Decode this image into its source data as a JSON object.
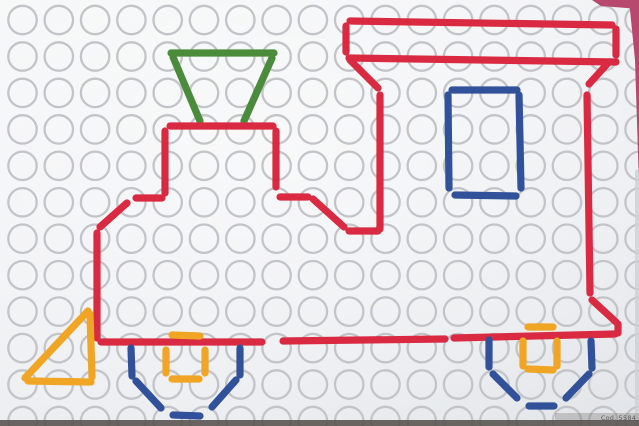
{
  "photo": {
    "subject": "pegboard toy showing a locomotive built from colored stick pieces",
    "caption": "Cod. 5584",
    "board": {
      "cols": 18,
      "rows": 12,
      "origin_x": 22.5,
      "origin_y": 20,
      "spacing_x": 36.3,
      "spacing_y": 36.45,
      "hole_radius": 14.2,
      "hole_stroke_width": 2.3
    },
    "piece_width": 7.2,
    "colors": {
      "red": "#d92a42",
      "green": "#4a8b3c",
      "blue": "#31519a",
      "orange": "#f0a524",
      "hole_stroke": "#c2c4c8",
      "backdrop_pink": "#b8496e",
      "right_edge_gray": "#cdd0d4",
      "shadow": "#56514c"
    },
    "pieces": {
      "funnel_green": [
        [
          171,
          53,
          274,
          53
        ],
        [
          173,
          57,
          200,
          121
        ],
        [
          272,
          58,
          244,
          121
        ]
      ],
      "body_red": [
        [
          350,
          21,
          612,
          25
        ],
        [
          346,
          26,
          346,
          52
        ],
        [
          349,
          58,
          616,
          62
        ],
        [
          616,
          29,
          616,
          55
        ],
        [
          350,
          60,
          378,
          88
        ],
        [
          609,
          62,
          589,
          84
        ],
        [
          380,
          95,
          380,
          229
        ],
        [
          587,
          95,
          590,
          293
        ],
        [
          349,
          231,
          378,
          231
        ],
        [
          313,
          199,
          344,
          227
        ],
        [
          280,
          197,
          308,
          197
        ],
        [
          276,
          131,
          276,
          187
        ],
        [
          170,
          126,
          273,
          126
        ],
        [
          165,
          131,
          165,
          193
        ],
        [
          136,
          198,
          162,
          198
        ],
        [
          127,
          203,
          100,
          227
        ],
        [
          97,
          233,
          97,
          338
        ],
        [
          101,
          342,
          262,
          342
        ],
        [
          283,
          341,
          445,
          339
        ],
        [
          454,
          338,
          615,
          334
        ],
        [
          592,
          300,
          616,
          322
        ],
        [
          618,
          324,
          618,
          333
        ]
      ],
      "window_blue": [
        [
          452,
          90,
          517,
          90
        ],
        [
          448,
          95,
          449,
          188
        ],
        [
          519,
          95,
          521,
          188
        ],
        [
          455,
          195,
          516,
          196
        ]
      ],
      "cowcatcher_orange": [
        [
          88,
          311,
          25,
          378
        ],
        [
          28,
          381,
          91,
          382
        ],
        [
          90,
          314,
          92,
          377
        ]
      ],
      "front_wheel_blue": [
        [
          131,
          348,
          132,
          376
        ],
        [
          240,
          348,
          240,
          375
        ],
        [
          136,
          381,
          161,
          408
        ],
        [
          236,
          380,
          212,
          407
        ],
        [
          173,
          415,
          200,
          416
        ]
      ],
      "front_hub_orange": [
        [
          172,
          335,
          200,
          336
        ],
        [
          166,
          350,
          166,
          373
        ],
        [
          205,
          350,
          205,
          373
        ],
        [
          172,
          379,
          199,
          379
        ]
      ],
      "rear_wheel_blue": [
        [
          489,
          340,
          489,
          367
        ],
        [
          591,
          341,
          592,
          368
        ],
        [
          493,
          374,
          517,
          398
        ],
        [
          589,
          374,
          566,
          398
        ],
        [
          529,
          406,
          554,
          406
        ]
      ],
      "rear_hub_orange": [
        [
          528,
          327,
          553,
          327
        ],
        [
          523,
          341,
          523,
          366
        ],
        [
          557,
          341,
          557,
          366
        ],
        [
          528,
          369,
          553,
          370
        ]
      ]
    }
  }
}
